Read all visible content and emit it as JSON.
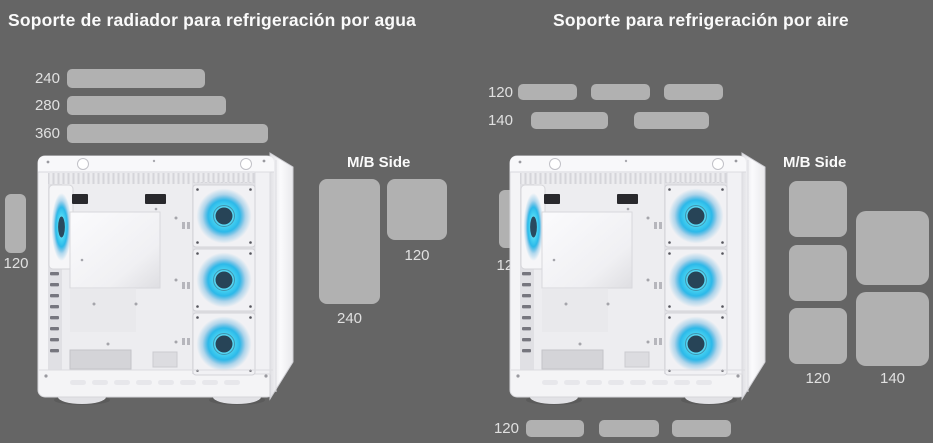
{
  "left": {
    "title": "Soporte de radiador para refrigeración por agua",
    "top_bars": [
      {
        "label": "240"
      },
      {
        "label": "280"
      },
      {
        "label": "360"
      }
    ],
    "rear_fan": {
      "label": "120"
    },
    "mb_side": {
      "heading": "M/B Side",
      "radiator_240": {
        "label": "240"
      },
      "fan_120": {
        "label": "120"
      }
    }
  },
  "right": {
    "title": "Soporte para refrigeración por aire",
    "top_fan_rows": [
      {
        "label": "120",
        "count": 3
      },
      {
        "label": "140",
        "count": 2
      }
    ],
    "rear_fan": {
      "label": "120"
    },
    "mb_side": {
      "heading": "M/B Side",
      "fans_120": {
        "label": "120",
        "count": 3
      },
      "fans_140": {
        "label": "140",
        "count": 2
      }
    },
    "bottom_fan_row": {
      "label": "120",
      "count": 3
    }
  },
  "colors": {
    "background": "#656565",
    "bar": "#b1b1b1",
    "label_text": "#e0e0e0",
    "title_text": "#fafafa",
    "fan_glow": "#3fd0f2",
    "case_body": "#f4f4f6"
  }
}
